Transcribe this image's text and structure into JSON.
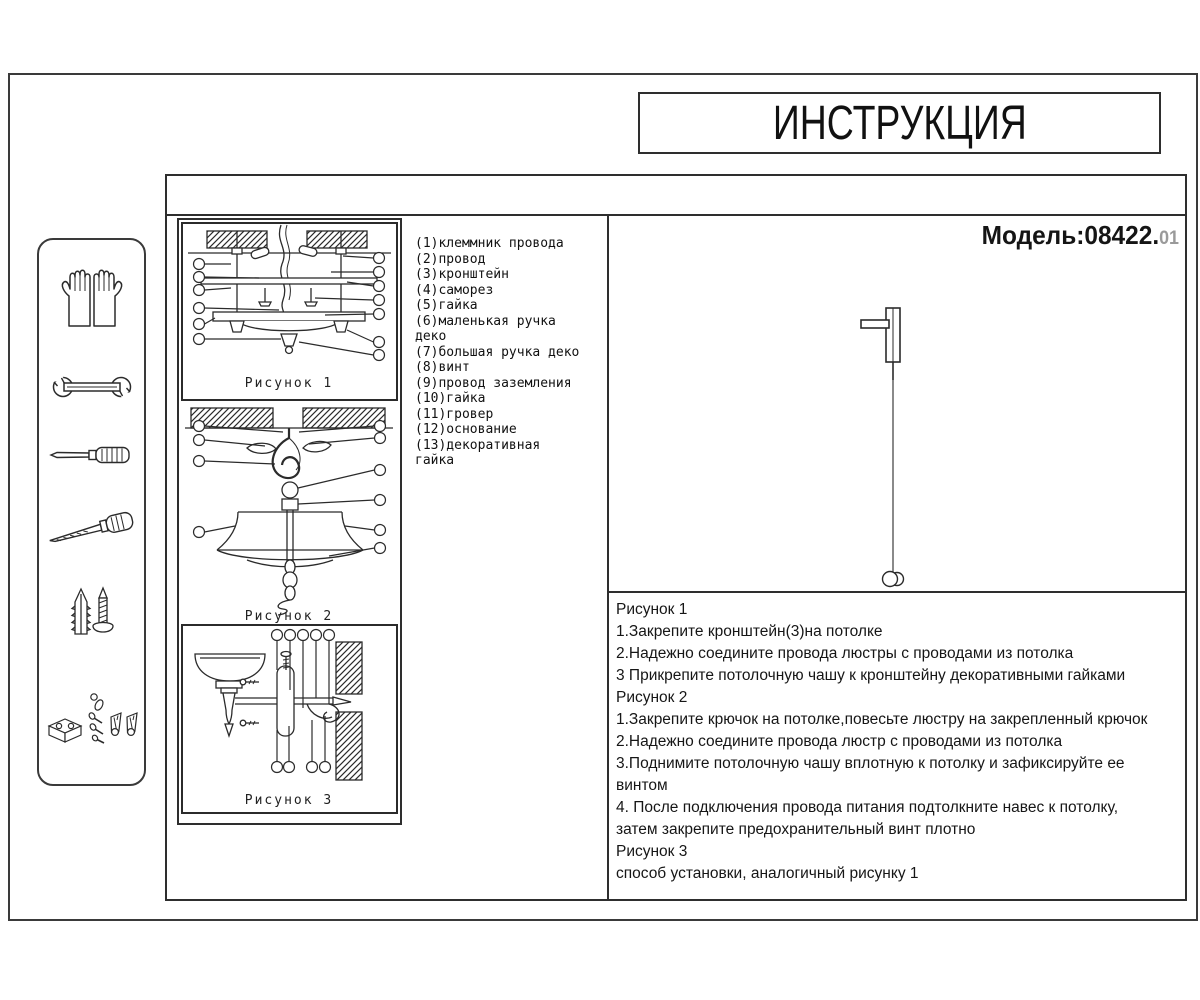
{
  "header": {
    "title": "ИНСТРУКЦИЯ"
  },
  "model": {
    "label": "Модель:08422.",
    "suffix": "01"
  },
  "parts": {
    "items": [
      "(1)клеммник провода",
      "(2)провод",
      "(3)кронштейн",
      "(4)саморез",
      "(5)гайка",
      "(6)маленькая ручка деко",
      "(7)большая ручка деко",
      "(8)винт",
      "(9)провод заземления",
      "(10)гайка",
      "(11)гровер",
      "(12)основание",
      "(13)декоративная гайка"
    ]
  },
  "figures": {
    "captions": [
      "Рисунок 1",
      "Рисунок 2",
      "Рисунок 3"
    ]
  },
  "instructions": {
    "lines": [
      "Рисунок 1",
      "1.Закрепите кронштейн(3)на потолке",
      "2.Надежно соедините провода люстры с проводами из потолка",
      "3 Прикрепите потолочную чашу к кронштейну декоративными гайками",
      "Рисунок 2",
      "1.Закрепите крючок на потолке,повесьте люстру на закрепленный крючок",
      "2.Надежно соедините провода люстр с проводами из потолка",
      "3.Поднимите потолочную чашу вплотную к потолку и зафиксируйте ее",
      "винтом",
      "4.  После подключения провода питания подтолкните навес к потолку,",
      "затем закрепите предохранительный винт плотно",
      "Рисунок 3",
      "способ установки, аналогичный рисунку 1"
    ]
  },
  "sidebar": {
    "icons": [
      "gloves-icon",
      "wrench-icon",
      "screwdriver-icon",
      "awl-icon",
      "anchor-screw-icon",
      "hardware-kit-icon"
    ]
  },
  "colors": {
    "ink": "#1c1c1c",
    "line": "#2e2e2e",
    "muted": "#9a9a9a",
    "paper": "#ffffff"
  }
}
